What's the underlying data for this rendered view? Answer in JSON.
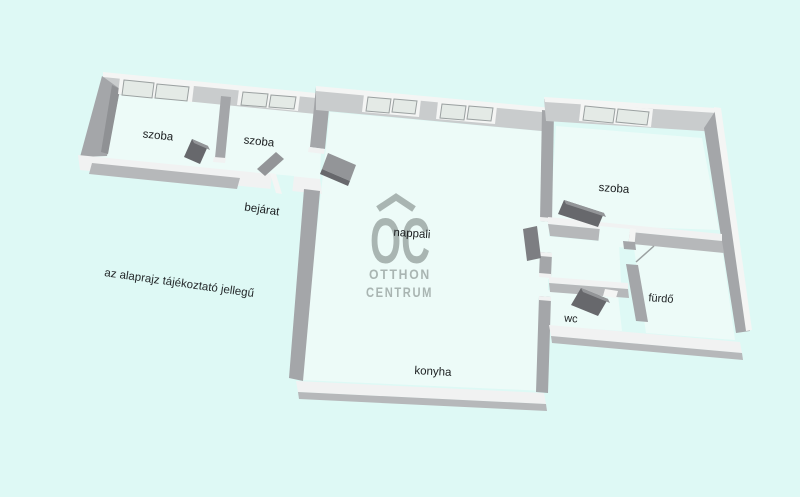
{
  "disclaimer": "az alaprajz tájékoztató jellegű",
  "watermark": {
    "monogram": "OC",
    "line1": "OTTHON",
    "line2": "CENTRUM"
  },
  "rooms": {
    "szoba_left": "szoba",
    "szoba_mid": "szoba",
    "bejarat": "bejárat",
    "nappali": "nappali",
    "konyha": "konyha",
    "szoba_right": "szoba",
    "furdo": "fürdő",
    "wc": "wc"
  },
  "palette": {
    "bg": "#def9f5",
    "floor": "#edfbf8",
    "wallTop": "#c9cccd",
    "wallTopLight": "#f4f5f4",
    "wallSide": "#a4a6a9",
    "wallSideDark": "#8f9194",
    "wallWhite": "#f1f2f2",
    "wallShade": "#b6b8ba",
    "doorDark": "#67686c",
    "doorMid": "#939598",
    "doorAlt": "#7d7e82",
    "pane": "#e4eae6",
    "paneEdge": "#9ba1a1",
    "label": "#1a1d1f",
    "disclaimerColor": "#24282a",
    "logo": "#a9b5b2"
  }
}
